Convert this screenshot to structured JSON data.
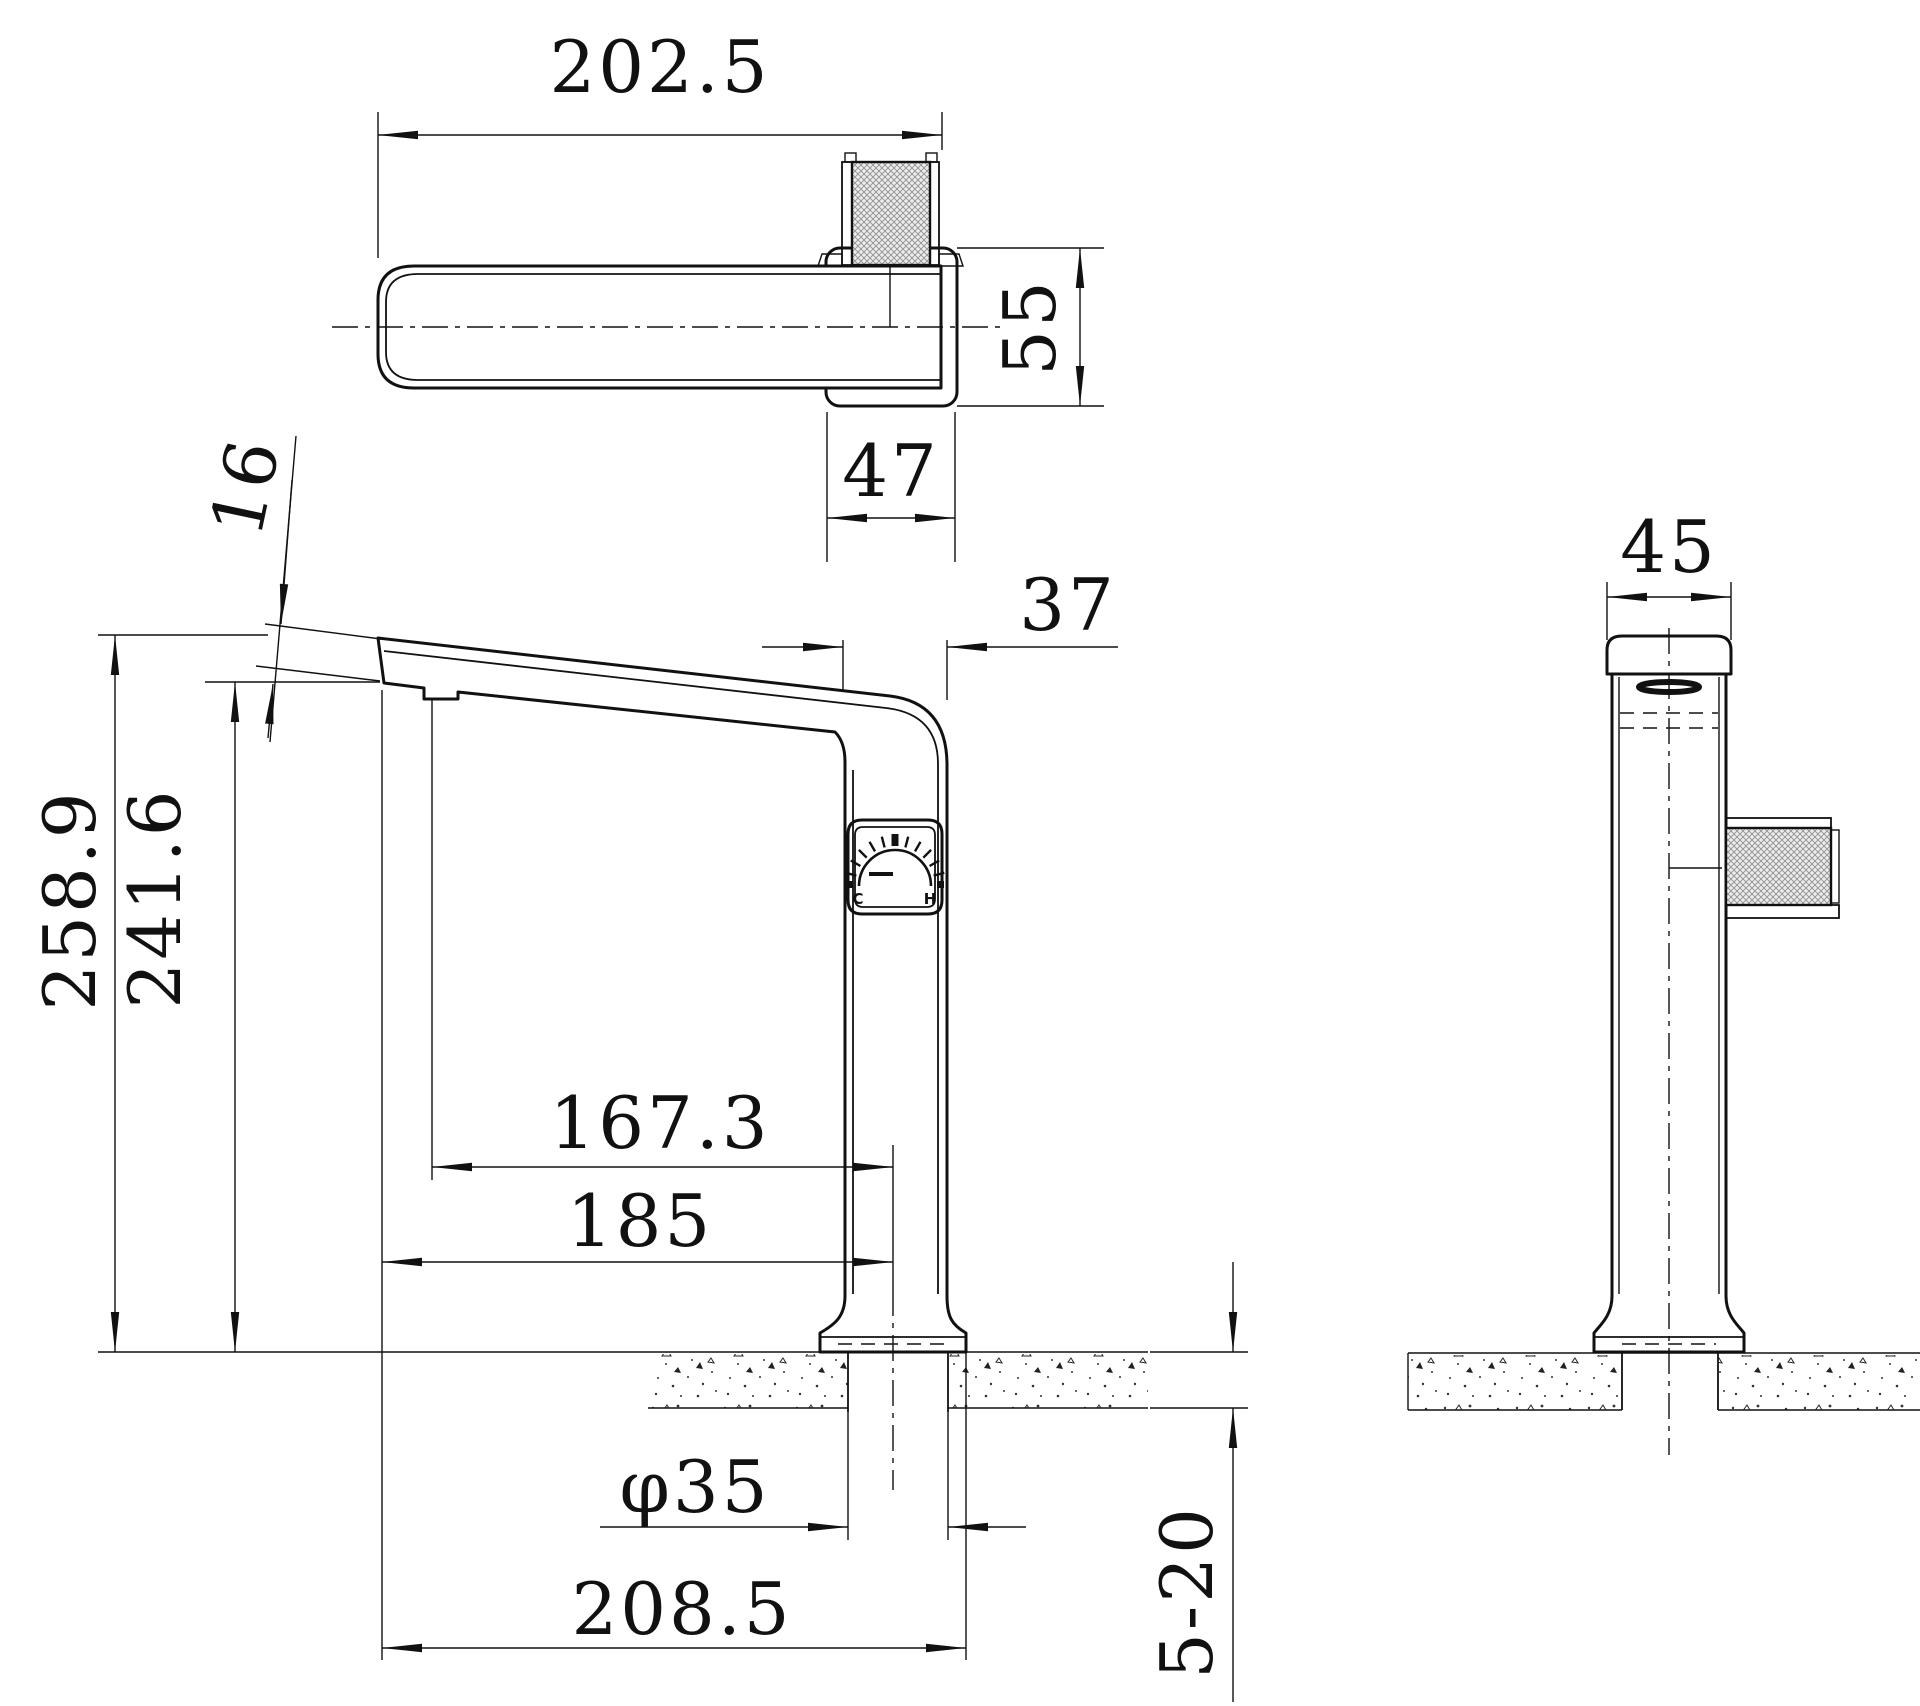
{
  "drawing": {
    "top_view": {
      "length": "202.5",
      "depth": "55",
      "body_width": "47"
    },
    "front_view": {
      "tip_thickness": "16",
      "overall_height": "258.9",
      "spout_height": "241.6",
      "body_width": "37",
      "aerator_to_center": "167.3",
      "tip_to_center": "185",
      "shank_diameter": "φ35",
      "tip_to_base_edge": "208.5",
      "deck_thickness": "5-20",
      "dial": {
        "cold": "C",
        "hot": "H"
      }
    },
    "side_view": {
      "width": "45"
    }
  }
}
